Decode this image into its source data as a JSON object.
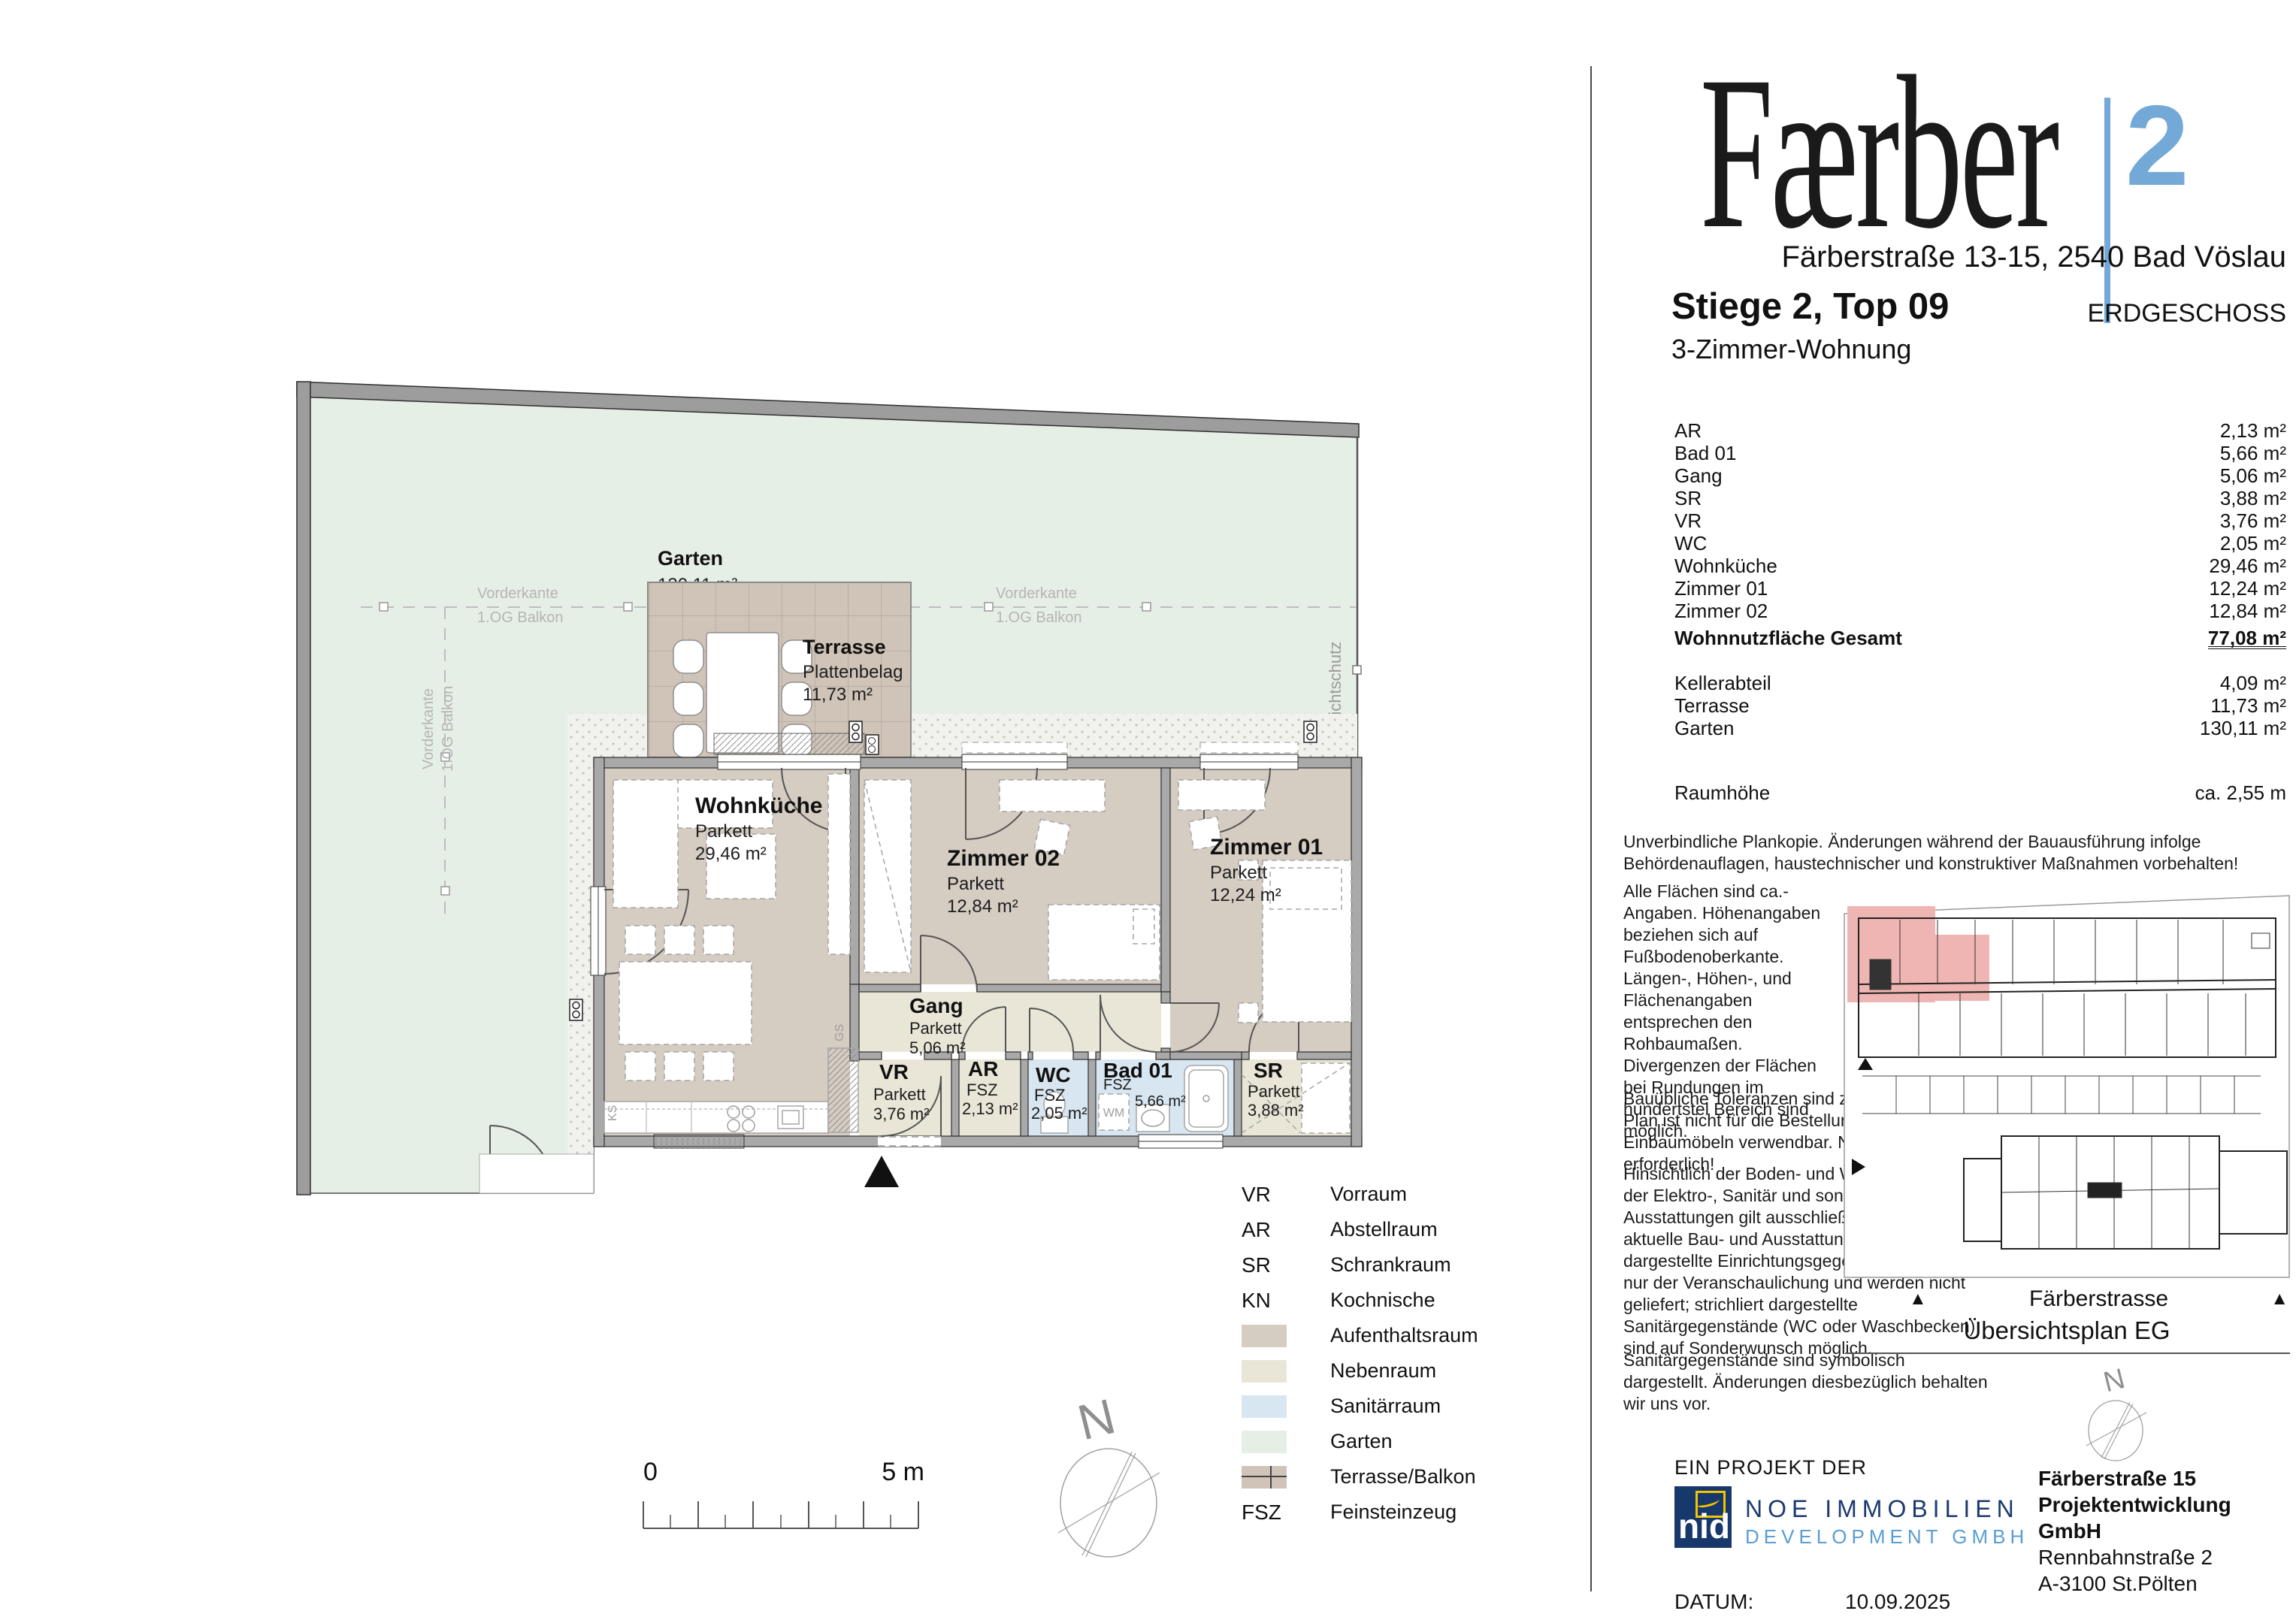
{
  "brand": {
    "name": "Færber",
    "superscript": "2",
    "address": "Färberstraße 13-15, 2540 Bad Vöslau"
  },
  "unit": {
    "title": "Stiege 2, Top 09",
    "type": "3-Zimmer-Wohnung",
    "floor": "ERDGESCHOSS"
  },
  "area_table": {
    "rows": [
      {
        "label": "AR",
        "value": "2,13 m²"
      },
      {
        "label": "Bad 01",
        "value": "5,66 m²"
      },
      {
        "label": "Gang",
        "value": "5,06 m²"
      },
      {
        "label": "SR",
        "value": "3,88 m²"
      },
      {
        "label": "VR",
        "value": "3,76 m²"
      },
      {
        "label": "WC",
        "value": "2,05 m²"
      },
      {
        "label": "Wohnküche",
        "value": "29,46 m²"
      },
      {
        "label": "Zimmer 01",
        "value": "12,24 m²"
      },
      {
        "label": "Zimmer 02",
        "value": "12,84 m²"
      }
    ],
    "total": {
      "label": "Wohnnutzfläche Gesamt",
      "value": "77,08 m²"
    },
    "extras": [
      {
        "label": "Kellerabteil",
        "value": "4,09 m²"
      },
      {
        "label": "Terrasse",
        "value": "11,73 m²"
      },
      {
        "label": "Garten",
        "value": "130,11 m²"
      }
    ],
    "room_height": {
      "label": "Raumhöhe",
      "value": "ca. 2,55 m"
    }
  },
  "notes": {
    "p1": "Unverbindliche Plankopie. Änderungen während der Bauausführung infolge Behördenauflagen, haustechnischer und konstruktiver Maßnahmen vorbehalten!",
    "p2": "Alle Flächen sind ca.- Angaben. Höhenangaben beziehen sich auf Fußbodenoberkante. Längen-, Höhen-, und Flächenangaben entsprechen den Rohbaumaßen. Divergenzen der Flächen bei Rundungen im hundertstel Bereich sind möglich.",
    "p3": "Bauübliche Toleranzen sind zulässig. Dieser Plan ist nicht für die Bestellung von Einbaumöbeln verwendbar. Naturmaße erforderlich!",
    "p4": "Hinsichtlich der Boden- und Wandbeläge, sowie der Elektro-, Sanitär und sonstigen Ausstattungen gilt ausschließlich die jeweils aktuelle Bau- und Ausstattungsbeschreibung; dargestellte Einrichtungsgegenstände dienen nur der Veranschaulichung und werden nicht geliefert; strichliert dargestellte Sanitärgegenstände (WC oder Waschbecken) sind auf Sonderwunsch möglich.",
    "p5": "Sanitärgegenstände sind symbolisch dargestellt. Änderungen diesbezüglich behalten wir uns vor."
  },
  "plan": {
    "garden": {
      "name": "Garten",
      "area": "130,11 m²"
    },
    "terrace": {
      "name": "Terrasse",
      "material": "Plattenbelag",
      "area": "11,73 m²"
    },
    "rooms": [
      {
        "name": "Wohnküche",
        "material": "Parkett",
        "area": "29,46 m²"
      },
      {
        "name": "Zimmer 02",
        "material": "Parkett",
        "area": "12,84 m²"
      },
      {
        "name": "Zimmer 01",
        "material": "Parkett",
        "area": "12,24 m²"
      },
      {
        "name": "Gang",
        "material": "Parkett",
        "area": "5,06 m²"
      },
      {
        "name": "VR",
        "material": "Parkett",
        "area": "3,76 m²"
      },
      {
        "name": "AR",
        "material": "FSZ",
        "area": "2,13 m²"
      },
      {
        "name": "WC",
        "material": "FSZ",
        "area": "2,05 m²"
      },
      {
        "name": "Bad 01",
        "material": "FSZ",
        "area": "5,66 m²"
      },
      {
        "name": "SR",
        "material": "Parkett",
        "area": "3,88 m²"
      }
    ],
    "annotations": {
      "vorderkante1": "Vorderkante",
      "vorderkante2": "1.OG Balkon",
      "sichtschutz": "Sichtschutz",
      "ks": "KS",
      "gs": "GS",
      "wm": "WM"
    },
    "scale": {
      "start": "0",
      "end": "5 m"
    },
    "north": "N"
  },
  "legend": {
    "abbreviations": [
      {
        "abbr": "VR",
        "label": "Vorraum"
      },
      {
        "abbr": "AR",
        "label": "Abstellraum"
      },
      {
        "abbr": "SR",
        "label": "Schrankraum"
      },
      {
        "abbr": "KN",
        "label": "Kochnische"
      }
    ],
    "swatches": [
      {
        "label": "Aufenthaltsraum",
        "color": "#d5ccc2"
      },
      {
        "label": "Nebenraum",
        "color": "#eae6d7"
      },
      {
        "label": "Sanitärraum",
        "color": "#d8e6f1"
      },
      {
        "label": "Garten",
        "color": "#e6efe5"
      },
      {
        "label": "Terrasse/Balkon",
        "color": "#cfc4b7"
      }
    ],
    "fsz": {
      "abbr": "FSZ",
      "label": "Feinsteinzeug"
    }
  },
  "overview": {
    "street": "Färberstrasse",
    "caption": "Übersichtsplan EG",
    "north": "N",
    "highlight_color": "#efb5b2"
  },
  "footer": {
    "project_label": "EIN PROJEKT DER",
    "logo_text": "nid",
    "company_line1": "NOE IMMOBILIEN",
    "company_line2": "DEVELOPMENT GMBH",
    "developer_line1": "Färberstraße 15",
    "developer_line2": "Projektentwicklung GmbH",
    "developer_line3": "Rennbahnstraße 2",
    "developer_line4": "A-3100 St.Pölten",
    "date_label": "DATUM:",
    "date_value": "10.09.2025"
  },
  "colors": {
    "accent_blue": "#73a9d7",
    "wall_gray": "#a9a9a9",
    "aufenthaltsraum": "#d5ccc2",
    "nebenraum": "#eae6d7",
    "sanitaerraum": "#d8e6f1",
    "garten": "#e6efe5",
    "terrasse": "#cfc4b7",
    "highlight_pink": "#efb5b2",
    "navy": "#1c3a6e",
    "light_blue": "#5b9ed2"
  }
}
